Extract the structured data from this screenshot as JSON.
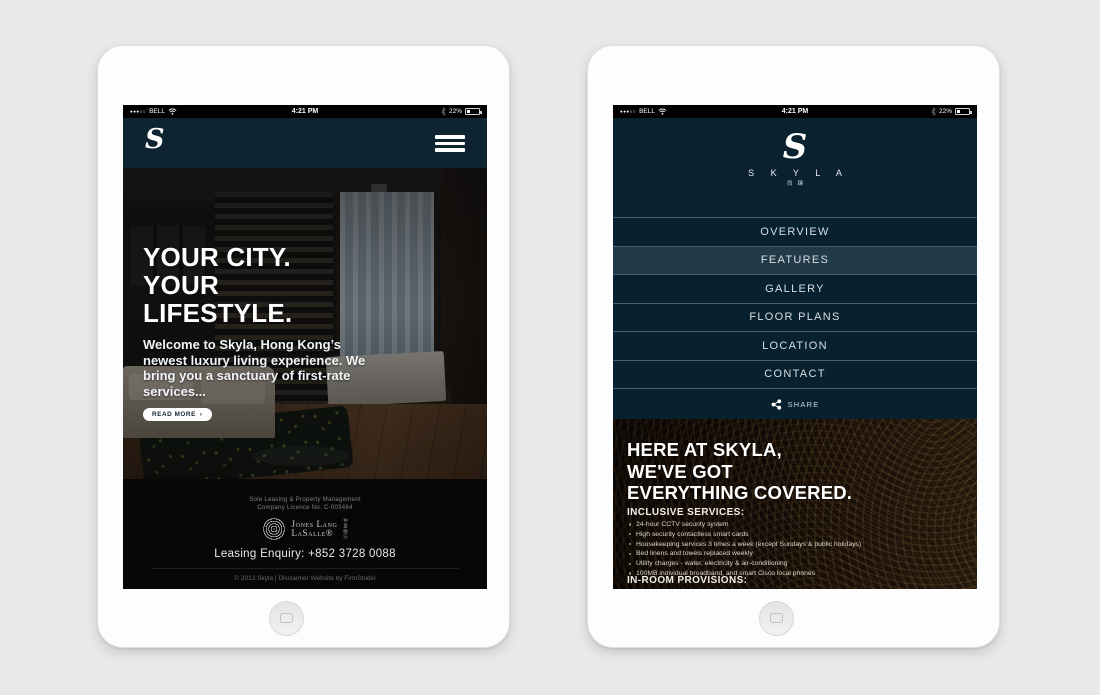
{
  "colors": {
    "page_bg": "#e9e9ea",
    "tablet": "#fdfdfe",
    "navy_header": "#0e2431",
    "navy_panel": "#0a2230",
    "menu_row": "#08212e",
    "menu_active": "#223b49",
    "menu_divider": "#41606d",
    "footer_bg": "#070708",
    "content_texture_base": "#180f08",
    "text_white": "#ffffff"
  },
  "status_bar": {
    "signal": "●●●○○",
    "carrier": "BELL",
    "time": "4:21 PM",
    "battery_percent": "22%"
  },
  "left_tablet": {
    "header": {
      "logo": "S"
    },
    "hero": {
      "title_line1": "YOUR CITY.",
      "title_line2": "YOUR",
      "title_line3": "LIFESTYLE.",
      "body": "Welcome to Skyla, Hong Kong’s newest luxury living experience. We bring you a sanctuary of first-rate services...",
      "cta_label": "READ MORE",
      "cta_arrow": "›",
      "carousel": {
        "count": 3,
        "active_index": 0
      }
    },
    "footer": {
      "line1": "Sole Leasing & Property Management",
      "line2": "Company Licence No. C-003464",
      "jll_line1": "Jones Lang",
      "jll_line2": "LaSalle®",
      "jll_cjk": "仲量聯行",
      "enquiry": "Leasing Enquiry: +852 3728 0088",
      "copyright": "© 2013 Skyla | Disclaimer Website by FirmStudio"
    }
  },
  "right_tablet": {
    "logo": {
      "mark": "S",
      "name": "S K Y L A",
      "cjk": "尚臻"
    },
    "menu": {
      "items": [
        {
          "label": "OVERVIEW",
          "active": false
        },
        {
          "label": "FEATURES",
          "active": true
        },
        {
          "label": "GALLERY",
          "active": false
        },
        {
          "label": "FLOOR PLANS",
          "active": false
        },
        {
          "label": "LOCATION",
          "active": false
        },
        {
          "label": "CONTACT",
          "active": false
        }
      ],
      "share_label": "SHARE"
    },
    "content": {
      "heading_line1": "HERE AT SKYLA,",
      "heading_line2": "WE'VE GOT",
      "heading_line3": "EVERYTHING COVERED.",
      "services_title": "INCLUSIVE SERVICES:",
      "services": [
        "24-hour CCTV security system",
        "High security contactless smart cards",
        "Housekeeping services 3 times a week (except Sundays & public holidays)",
        "Bed linens and towels replaced weekly",
        "Utility charges - water, electricity & air-conditioning",
        "100MB individual broadband, and smart Cisco local phones"
      ],
      "provisions_title": "IN-ROOM PROVISIONS:"
    }
  }
}
